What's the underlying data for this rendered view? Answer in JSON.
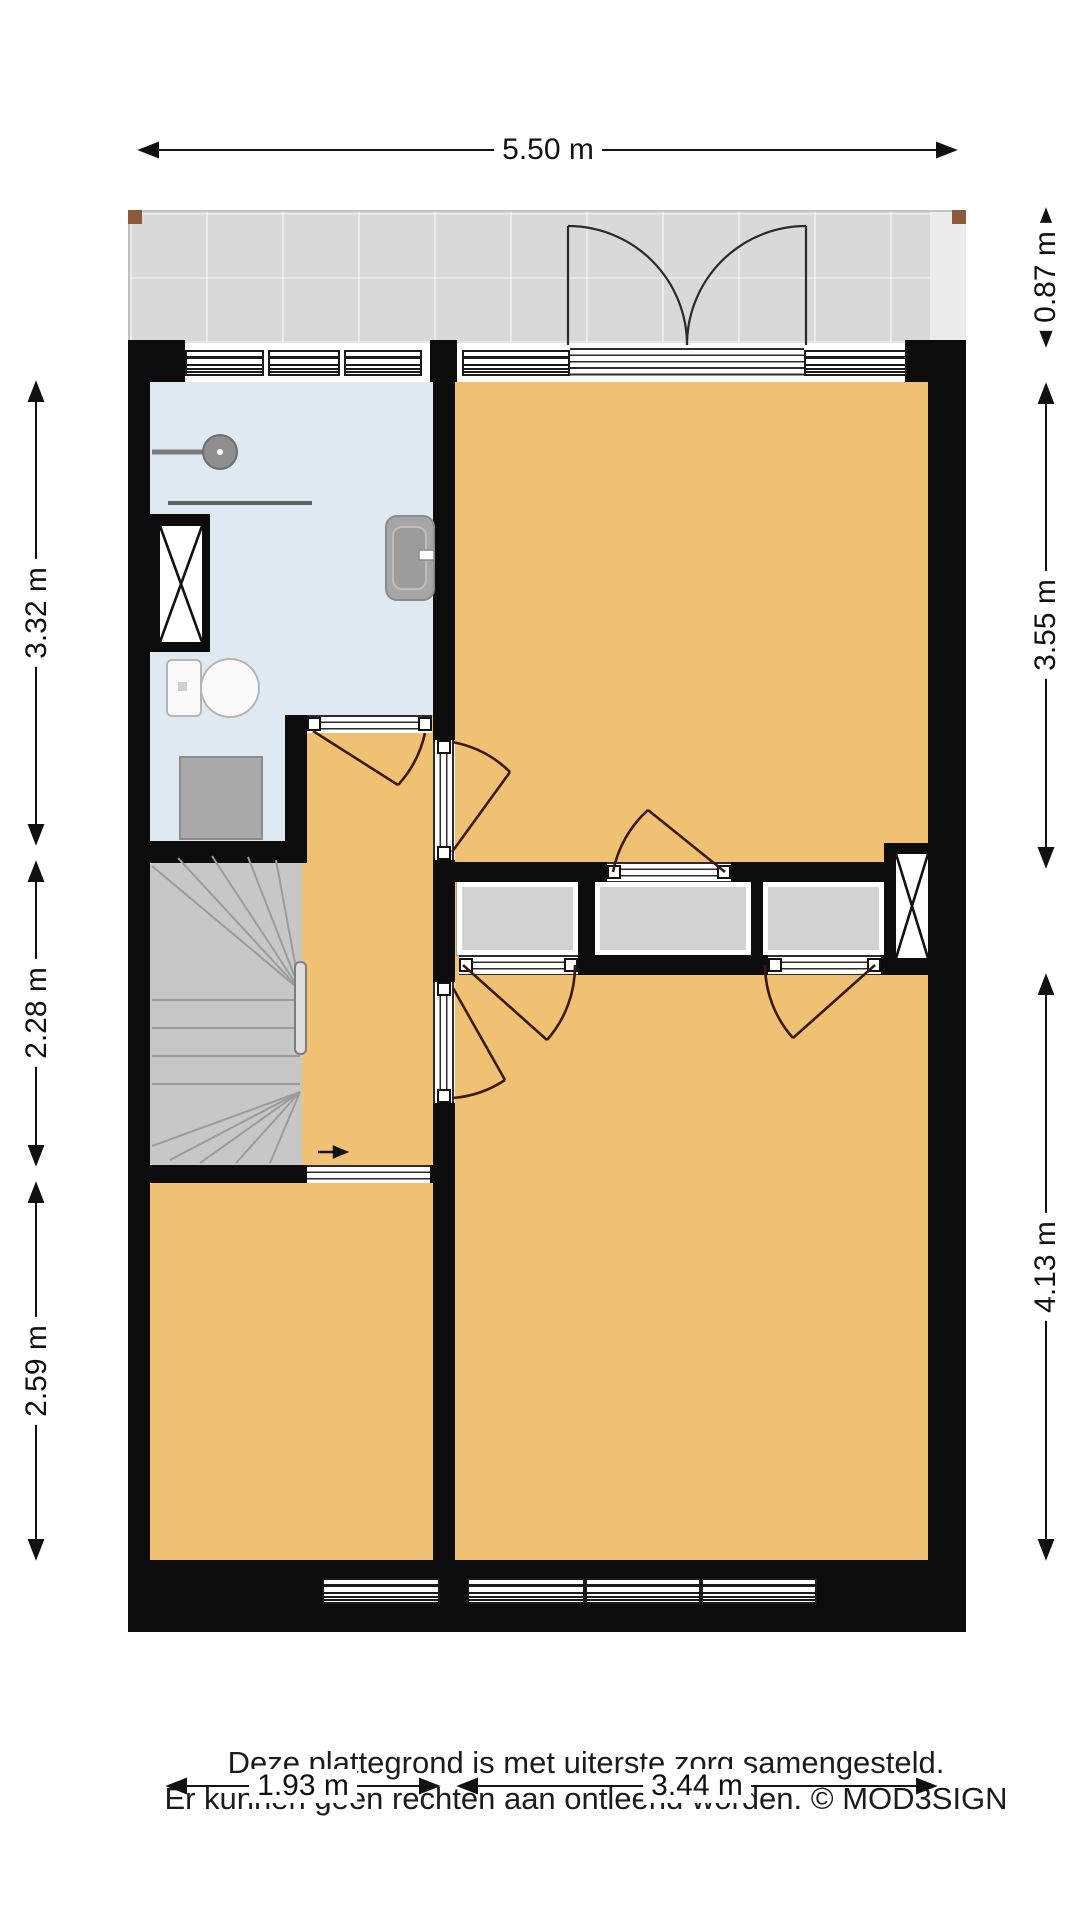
{
  "plan": {
    "rooms": {
      "balkon": "Balkon",
      "badkamer": "Badkamer",
      "slaapkamer_top": "Slaapkamer",
      "slaapkamer_bottom_right": "Slaapkamer",
      "slaapkamer_bottom_left": "Slaapkamer",
      "overloop_line1": "Overloop",
      "overloop_line2": "H=2.68m",
      "kast1": "Kast",
      "kast2": "Kast",
      "kast3": "Kast"
    },
    "dimensions": {
      "top_width": "5.50 m",
      "balcony_depth": "0.87 m",
      "right_upper": "3.55 m",
      "right_lower": "4.13 m",
      "left_upper": "3.32 m",
      "left_middle": "2.28 m",
      "left_lower": "2.59 m",
      "bottom_left": "1.93 m",
      "bottom_right": "3.44 m"
    },
    "colors": {
      "wall": "#0c0c0c",
      "floor_room": "#f0c173",
      "floor_bathroom": "#dfe9f2",
      "floor_balcony": "#d9d9d9",
      "floor_stairs": "#c7c7c7",
      "closet_fill": "#d2d2d2",
      "door_swing": "#3a1a10",
      "post_brown": "#8a5a3b"
    }
  },
  "footer": {
    "line1": "Deze plattegrond is met uiterste zorg samengesteld.",
    "line2": "Er kunnen geen rechten aan ontleend worden. © MOD3SIGN"
  }
}
